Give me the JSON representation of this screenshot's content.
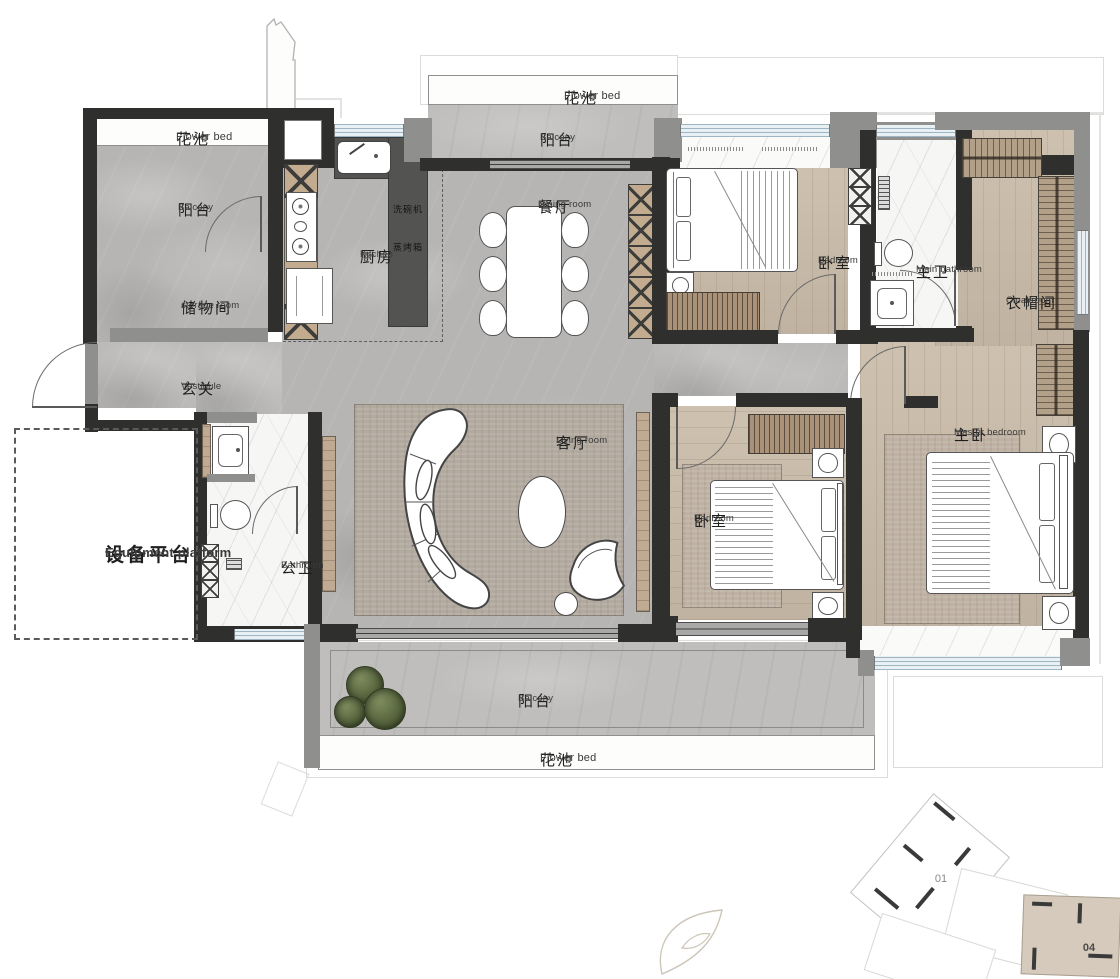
{
  "plan": {
    "rooms": {
      "flower_bed_tl": {
        "zh": "花池",
        "en": "Flower bed"
      },
      "balcony_tl": {
        "zh": "阳台",
        "en": "Balcony"
      },
      "storage": {
        "zh": "储物间",
        "en": "storage room"
      },
      "vestibule": {
        "zh": "玄关",
        "en": "Vestibule"
      },
      "kitchen": {
        "zh": "厨房",
        "en": "Kitchen"
      },
      "flower_bed_top": {
        "zh": "花池",
        "en": "Flower bed"
      },
      "balcony_top": {
        "zh": "阳台",
        "en": "Balcony"
      },
      "dining": {
        "zh": "餐厅",
        "en": "Dining room"
      },
      "bedroom_top": {
        "zh": "卧室",
        "en": "Bedroom"
      },
      "main_bath": {
        "zh": "主卫",
        "en": "Main bathroom"
      },
      "cloakroom": {
        "zh": "衣帽间",
        "en": "Cloakroom"
      },
      "master": {
        "zh": "主卧",
        "en": "Master bedroom"
      },
      "bedroom_mid": {
        "zh": "卧室",
        "en": "Bedroom"
      },
      "living": {
        "zh": "客厅",
        "en": "Living room"
      },
      "public_bath": {
        "zh": "公卫",
        "en": "Bathroom"
      },
      "equipment": {
        "zh": "设备平台",
        "en": "Equipment platform"
      },
      "balcony_bottom": {
        "zh": "阳台",
        "en": "Balcony"
      },
      "flower_bed_bottom": {
        "zh": "花池",
        "en": "Flower bed"
      }
    },
    "appliances": {
      "dishwasher": "洗碗机",
      "steam_oven": "蒸烤箱"
    },
    "keyplan": {
      "unit_01": "01",
      "unit_04": "04"
    },
    "colors": {
      "wall_dark": "#2f2f2e",
      "wall_gray": "#8f8f8d",
      "floor_marble": "#b6b5b3",
      "floor_wood": "#cabca9",
      "floor_balcony": "#bfbebc",
      "cabinet_tan": "#c2ab8f",
      "window_glass": "#e9f0f3",
      "window_line": "#9db6c4",
      "keyplan_highlight": "#d5cabb",
      "plant_green": "#55633c"
    }
  }
}
